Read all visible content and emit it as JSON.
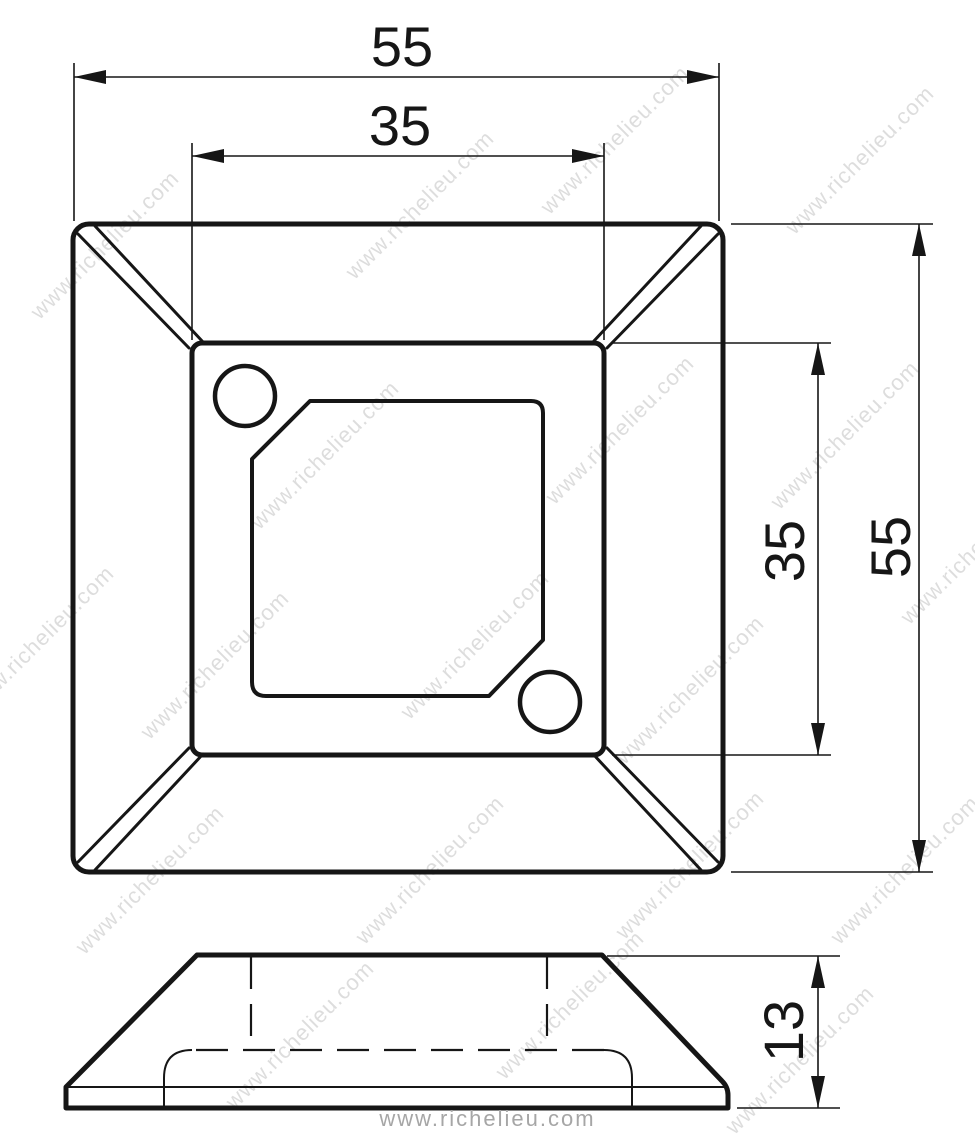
{
  "drawing": {
    "type": "technical-drawing",
    "line_color": "#161616",
    "dimensions": {
      "top_width": "55",
      "top_plateau_width": "35",
      "right_height": "55",
      "right_plateau_height": "35",
      "side_thickness": "13"
    }
  },
  "watermark": {
    "text": "www.richelieu.com",
    "color": "#c2c2c2"
  },
  "footer": {
    "text": "www.richelieu.com",
    "color": "#a6a6a6"
  }
}
